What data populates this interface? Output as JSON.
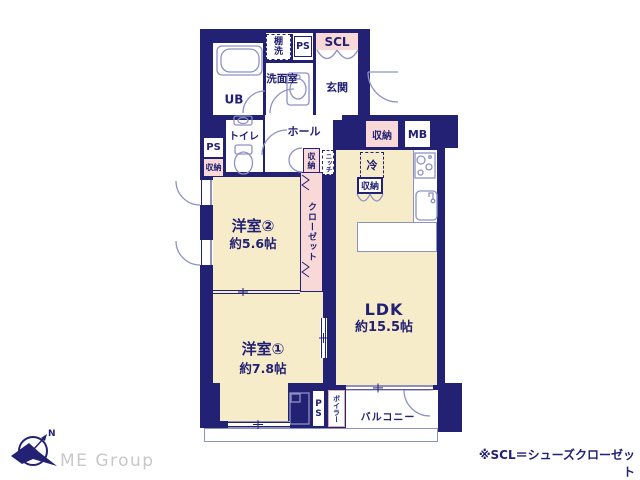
{
  "plan": {
    "labels": {
      "ub": "UB",
      "tana1": "棚",
      "tana2": "洗",
      "ps_top": "PS",
      "scl": "SCL",
      "senmen": "洗面室",
      "genkan": "玄関",
      "toilet": "トイレ",
      "hall": "ホール",
      "ps_left": "PS",
      "shuno_left": "収納",
      "shuno_genkan": "収納",
      "mb": "MB",
      "shuno_hall": "収納",
      "niche": "ニッチ",
      "rei": "冷",
      "shuno_kitchen": "収納",
      "closet": "クローゼット",
      "yoshitsu2_name": "洋室②",
      "yoshitsu2_size": "約5.6帖",
      "ldk_name": "LDK",
      "ldk_size": "約15.5帖",
      "yoshitsu1_name": "洋室①",
      "yoshitsu1_size": "約7.8帖",
      "ps_bottom": "PS",
      "boiler": "ボイラー",
      "balcony": "バルコニー"
    },
    "footer": {
      "logo_text": "ME Group",
      "compass_n": "N",
      "note": "※SCL＝シューズクローゼット"
    },
    "colors": {
      "wall_navy": "#232173",
      "room_cream": "#f7ecca",
      "storage_pink": "#f8d9d8",
      "fixture_line": "#8d92c4",
      "logo_gray": "#c8c8c8"
    }
  }
}
